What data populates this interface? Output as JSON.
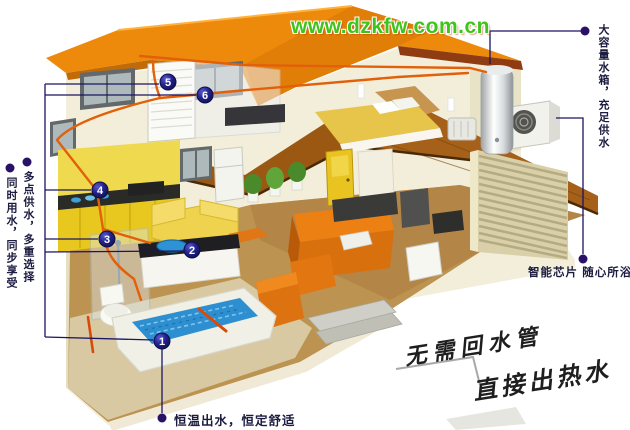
{
  "watermark": {
    "text": "www.dzkfw.com.cn",
    "color": "#3fc41c"
  },
  "callouts": {
    "left_top": "多点供水，多重选择",
    "left_bottom": "同时用水，同步享受",
    "right_top": "大容量水箱，充足供水",
    "right_bottom": "智能芯片  随心所浴",
    "bottom": "恒温出水，恒定舒适"
  },
  "slogan": {
    "line1": "无需回水管",
    "line2": "直接出热水"
  },
  "markers": [
    "1",
    "2",
    "3",
    "4",
    "5",
    "6"
  ],
  "colors": {
    "roof": "#ed8a0b",
    "wall": "#f2eeda",
    "wood_floor": "#9a5812",
    "tile_floor": "#bc9350",
    "water": "#2e8fd0",
    "sofa_orange": "#e87c10",
    "kitchen_yellow": "#e8c81e",
    "pipe": "#e2600a",
    "leader_line": "#1b1464",
    "marker_badge": "#16166a",
    "watermark_green": "#3fc41c"
  }
}
